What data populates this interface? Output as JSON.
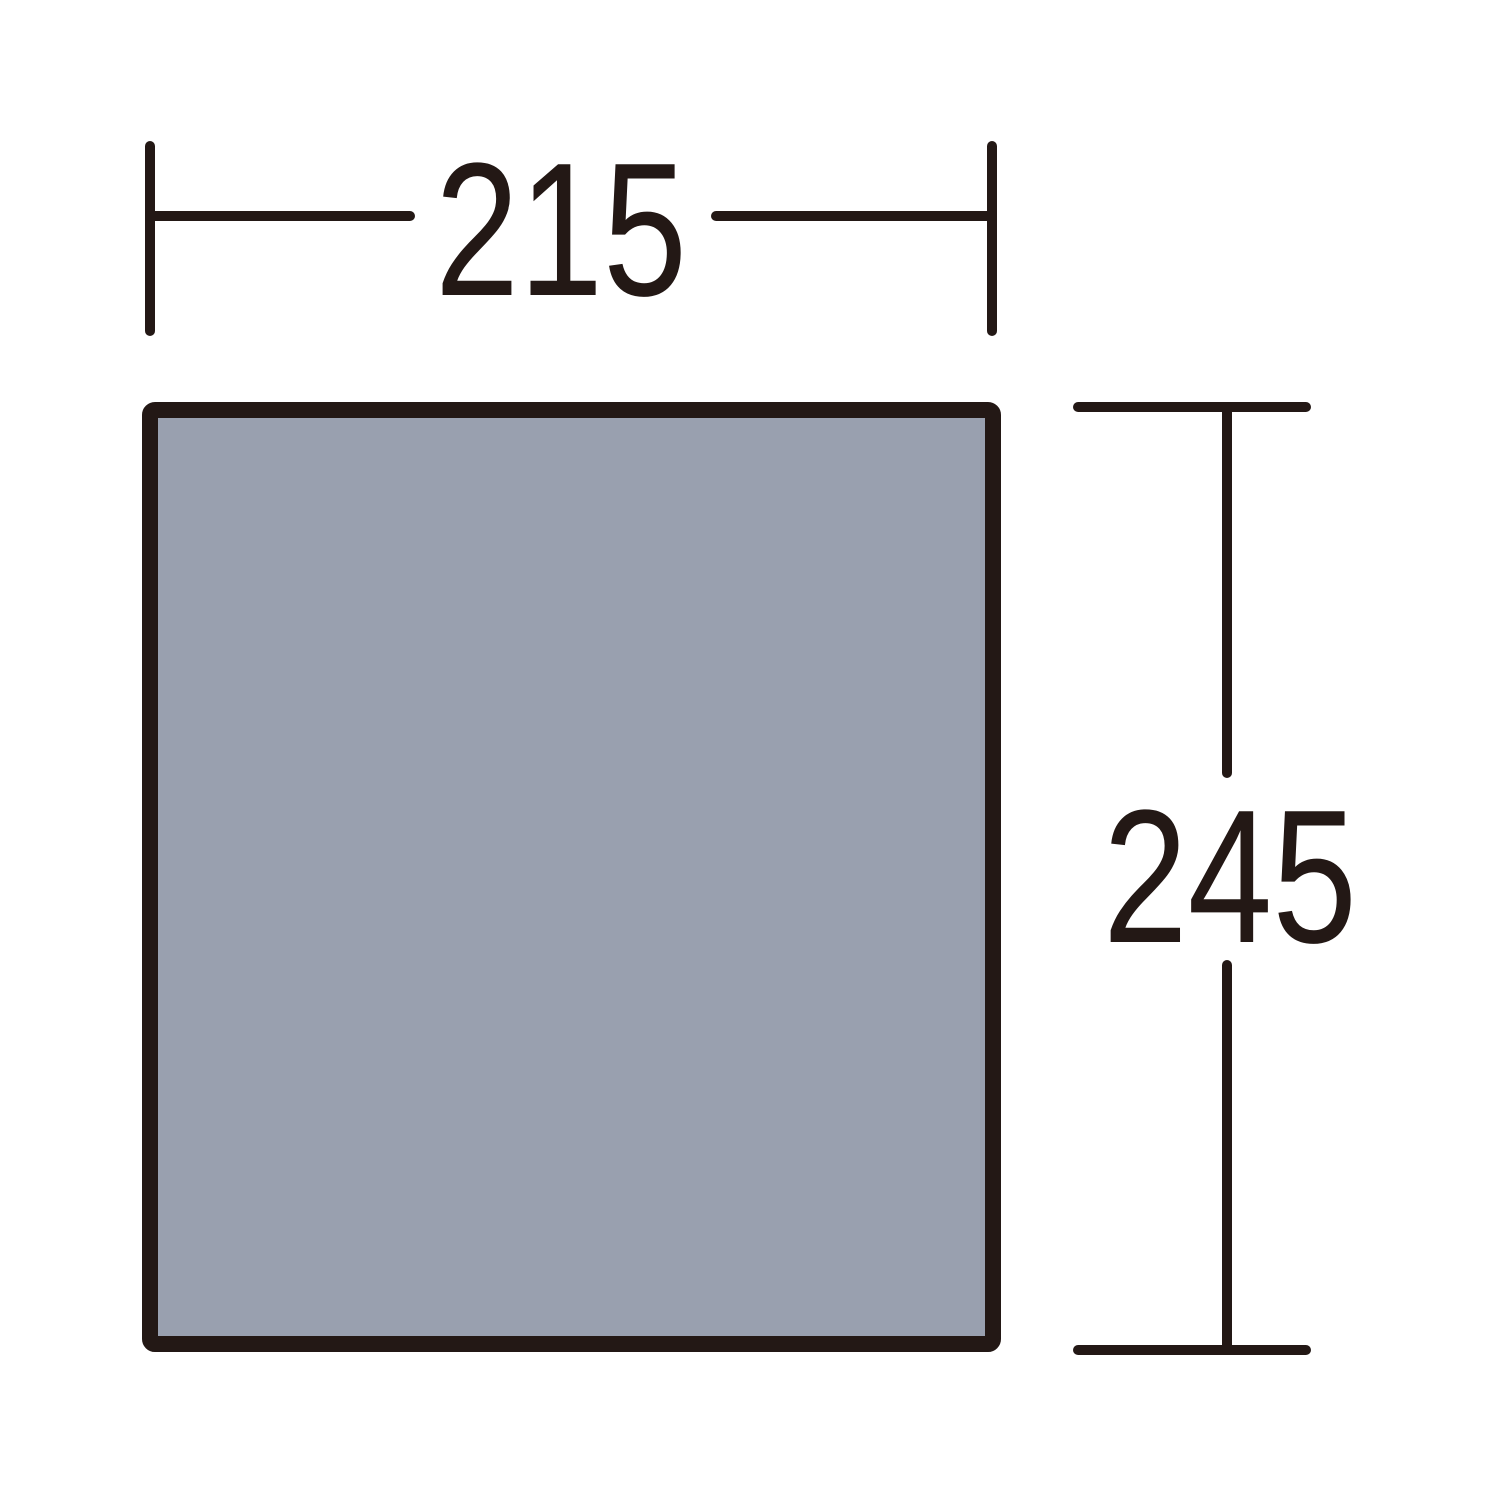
{
  "diagram": {
    "background_color": "#ffffff",
    "line_color": "#231815",
    "footprint": {
      "fill_color": "#99A0AF",
      "border_color": "#231815"
    },
    "dimensions": {
      "width": {
        "label": "215"
      },
      "height": {
        "label": "245"
      }
    }
  }
}
